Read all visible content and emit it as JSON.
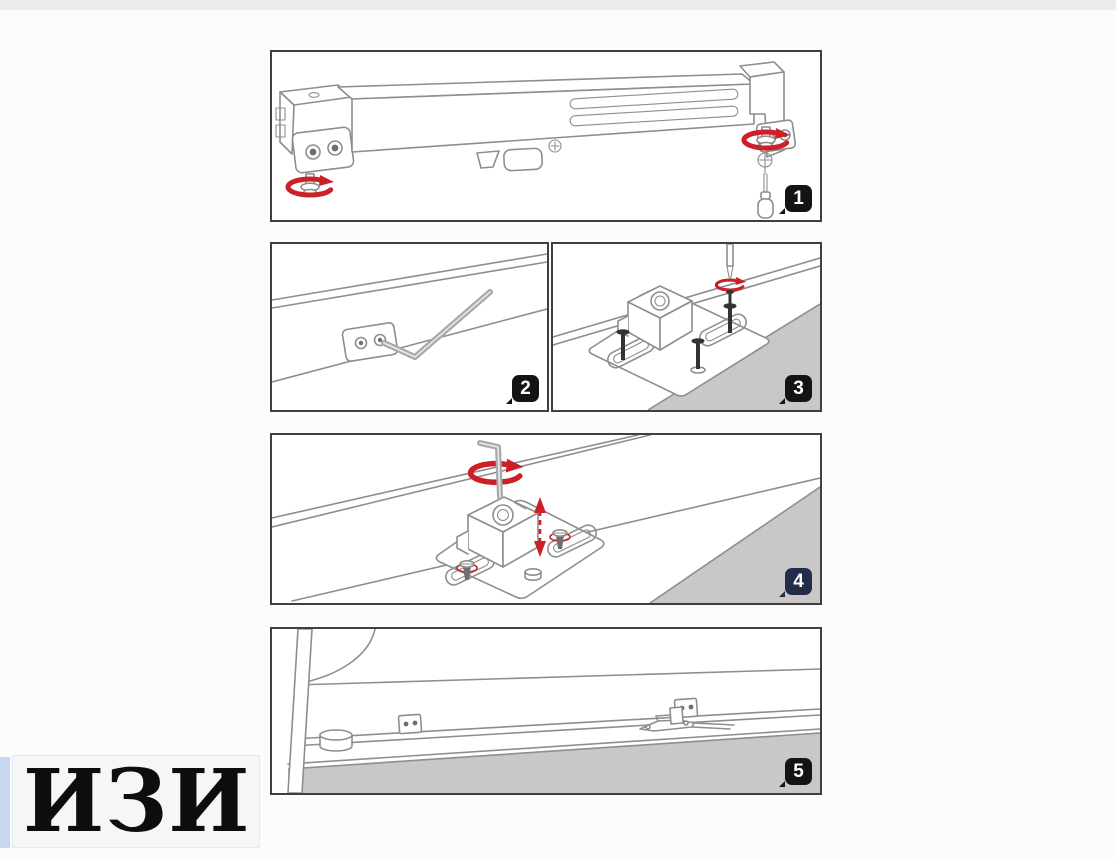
{
  "document": {
    "kind": "assembly-instruction-sheet",
    "step_count": 5
  },
  "steps": [
    {
      "number": "1",
      "illustration": "rail-with-end-brackets",
      "icons": [
        "rotation-arrow-icon",
        "rotation-arrow-icon",
        "phillips-screw-icon",
        "screwdriver-icon"
      ]
    },
    {
      "number": "2",
      "illustration": "hex-key-in-bracket-plate",
      "icons": [
        "allen-key-icon"
      ]
    },
    {
      "number": "3",
      "illustration": "mounting-plate-with-screws",
      "icons": [
        "screwdriver-icon",
        "rotation-arrow-icon",
        "screw-icon",
        "screw-icon",
        "screw-icon"
      ]
    },
    {
      "number": "4",
      "illustration": "height-adjustment-with-hex-key",
      "icons": [
        "allen-key-icon",
        "rotation-arrow-icon",
        "up-down-arrow-icon"
      ]
    },
    {
      "number": "5",
      "illustration": "installed-mechanism-on-cabinet-base",
      "icons": []
    }
  ],
  "watermark": {
    "text": "ИЗИ"
  },
  "colors": {
    "accent_red": "#cb2027",
    "line_gray": "#8e8e8e",
    "floor_gray": "#c9c8c6",
    "panel_border": "#3f3f3f",
    "badge_black": "#141414",
    "badge_navy": "#242c4c",
    "watermark_blue": "#c7d7ef"
  }
}
